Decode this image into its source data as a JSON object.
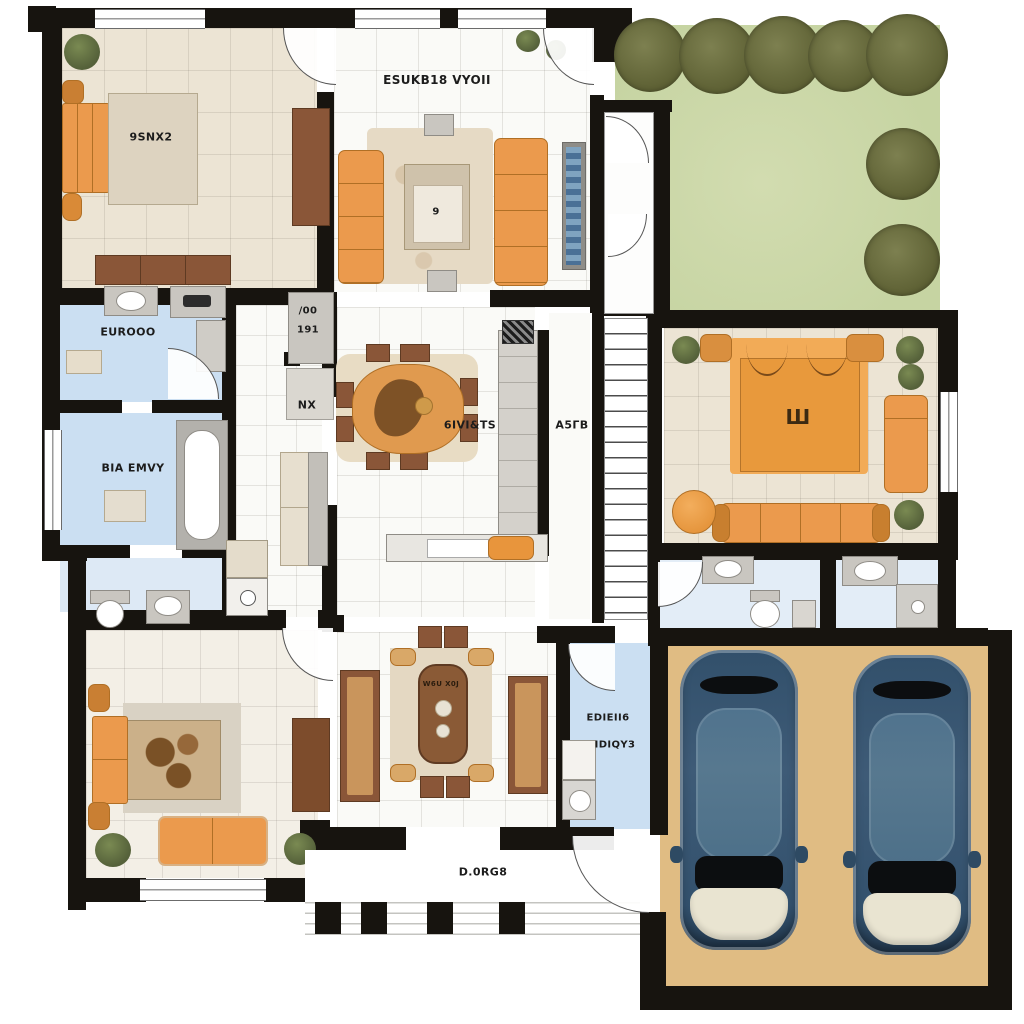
{
  "labels": {
    "bedroom1": "9SNX2",
    "living_room": "ESUKB18 VYOII",
    "bathroom1": "EUROOO",
    "bathroom2": "BIA EMVY",
    "hall_cabinet_top": "/00",
    "hall_cabinet_bottom": "191",
    "hallway": "NX",
    "kitchen_dining": "6IVI&TS",
    "stair_hall": "A5ГB",
    "laundry_line1": "EDIEII6",
    "laundry_line2": "IDIQY3",
    "porch": "D.0RG8",
    "coffee_table_glyph": "9",
    "master_rug_glyph": "Ш",
    "dining_table_doodle": "W6U X0J"
  },
  "scene": {
    "type": "residential floor plan, top view",
    "garden_bush_count": 7,
    "garage_car_count": 2
  },
  "colors": {
    "wall": "#17140f",
    "floor_white": "#fafaf7",
    "floor_beige": "#ece4d4",
    "floor_blue": "#cbdff2",
    "lawn": "#c6d4a2",
    "bush": "#6b6e41",
    "accent_orange": "#eb9a4d",
    "wood_brown": "#8a5638",
    "garage_floor": "#e0bc83",
    "car_body": "#3e5b77",
    "car_roof": "#57788f",
    "car_windshield": "#e9e4d1",
    "rug_beige": "#e6dac5"
  }
}
